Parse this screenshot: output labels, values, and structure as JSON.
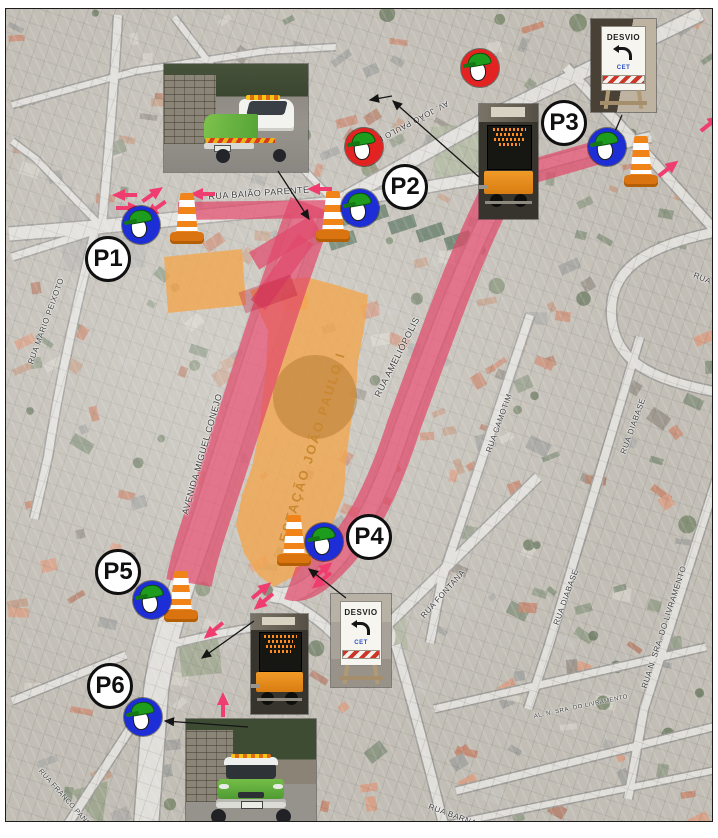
{
  "document": {
    "kind": "traffic-operation-plan-map",
    "area_label": "ESTAÇÃO JOÃO PAULO I"
  },
  "colors": {
    "closed_road": "#e0496b",
    "closed_road_dark_patch": "#be1e3c",
    "work_zone_orange": "#f3a64f",
    "work_zone_circle": "#ab7128",
    "arrow_pink": "#ee3d6e",
    "agent_blue": "#1d2ed6",
    "agent_red": "#e32222",
    "helmet_green": "#1e9c1e",
    "helmet_green_dark": "#157815",
    "cone_orange": "#f08418",
    "cone_base": "#da7410",
    "station_label_color": "#c9882f",
    "leader_black": "#151515"
  },
  "station": {
    "label": "ESTAÇÃO JOÃO PAULO I",
    "x": 306,
    "y": 438,
    "rot": -73,
    "size": 13
  },
  "points": [
    {
      "id": "P1",
      "label": "P1",
      "x": 102,
      "y": 250
    },
    {
      "id": "P2",
      "label": "P2",
      "x": 399,
      "y": 178
    },
    {
      "id": "P3",
      "label": "P3",
      "x": 558,
      "y": 114
    },
    {
      "id": "P4",
      "label": "P4",
      "x": 363,
      "y": 528
    },
    {
      "id": "P5",
      "label": "P5",
      "x": 112,
      "y": 563
    },
    {
      "id": "P6",
      "label": "P6",
      "x": 104,
      "y": 677
    }
  ],
  "agents": [
    {
      "variant": "blue",
      "x": 135,
      "y": 216
    },
    {
      "variant": "blue",
      "x": 354,
      "y": 199
    },
    {
      "variant": "blue",
      "x": 601,
      "y": 138
    },
    {
      "variant": "blue",
      "x": 318,
      "y": 533
    },
    {
      "variant": "blue",
      "x": 146,
      "y": 591
    },
    {
      "variant": "blue",
      "x": 137,
      "y": 708
    },
    {
      "variant": "red",
      "x": 358,
      "y": 138
    },
    {
      "variant": "red",
      "x": 474,
      "y": 59
    }
  ],
  "cones": [
    {
      "x": 181,
      "y": 209
    },
    {
      "x": 327,
      "y": 207
    },
    {
      "x": 635,
      "y": 152
    },
    {
      "x": 288,
      "y": 531
    },
    {
      "x": 175,
      "y": 587
    }
  ],
  "street_labels": [
    {
      "text": "RUA BAIÃO PARENTE",
      "x": 253,
      "y": 184,
      "rot": -4,
      "size": 9
    },
    {
      "text": "AV. JOÃO PAULO I",
      "x": 408,
      "y": 112,
      "rot": 152,
      "size": 8
    },
    {
      "text": "AVENIDA MIGUEL CONEJO",
      "x": 196,
      "y": 445,
      "rot": -74,
      "size": 9
    },
    {
      "text": "RUA AMELIÓPOLIS",
      "x": 391,
      "y": 348,
      "rot": -63,
      "size": 9
    },
    {
      "text": "RUA MARIO PEIXOTO",
      "x": 40,
      "y": 312,
      "rot": -70,
      "size": 8
    },
    {
      "text": "RUA FONTANA",
      "x": 437,
      "y": 585,
      "rot": -48,
      "size": 8
    },
    {
      "text": "RUA CAMOTIM",
      "x": 493,
      "y": 414,
      "rot": -70,
      "size": 8
    },
    {
      "text": "RUA DIABASE",
      "x": 627,
      "y": 417,
      "rot": -70,
      "size": 8
    },
    {
      "text": "RUA DIABASE",
      "x": 560,
      "y": 588,
      "rot": -70,
      "size": 8
    },
    {
      "text": "RUA N. SRA. DO LIVRAMENTO",
      "x": 658,
      "y": 618,
      "rot": -72,
      "size": 8
    },
    {
      "text": "RUA CA",
      "x": 703,
      "y": 272,
      "rot": 22,
      "size": 8
    },
    {
      "text": "RUA BARNABÉ",
      "x": 452,
      "y": 808,
      "rot": 20,
      "size": 8
    },
    {
      "text": "AL. N. SRA. DO LIVRAMENTO",
      "x": 575,
      "y": 698,
      "rot": -12,
      "size": 6
    },
    {
      "text": "RUA FRANCO PANCHA",
      "x": 62,
      "y": 793,
      "rot": 48,
      "size": 7
    }
  ],
  "signs": {
    "desvio": {
      "title": "DESVIO",
      "agency": "CET"
    }
  },
  "photos": [
    {
      "name": "support-pickup-photo-top",
      "type": "truck-side",
      "x": 158,
      "y": 55,
      "w": 144,
      "h": 108
    },
    {
      "name": "message-trailer-photo-top",
      "type": "trailer",
      "x": 473,
      "y": 95,
      "w": 59,
      "h": 115
    },
    {
      "name": "desvio-sign-photo-top",
      "type": "desvio",
      "bg": "dark",
      "x": 585,
      "y": 10,
      "w": 65,
      "h": 93
    },
    {
      "name": "desvio-sign-photo-mid",
      "type": "desvio",
      "bg": "light",
      "x": 325,
      "y": 585,
      "w": 60,
      "h": 93
    },
    {
      "name": "message-trailer-photo-mid",
      "type": "trailer",
      "x": 245,
      "y": 605,
      "w": 57,
      "h": 100
    },
    {
      "name": "support-pickup-photo-bottom",
      "type": "truck-front",
      "x": 180,
      "y": 710,
      "w": 130,
      "h": 112
    }
  ],
  "arrows": [
    {
      "x": 118,
      "y": 186,
      "rot": 180
    },
    {
      "x": 123,
      "y": 199,
      "rot": 0
    },
    {
      "x": 147,
      "y": 185,
      "rot": -35
    },
    {
      "x": 149,
      "y": 200,
      "rot": 145
    },
    {
      "x": 196,
      "y": 185,
      "rot": 180
    },
    {
      "x": 313,
      "y": 180,
      "rot": 180
    },
    {
      "x": 705,
      "y": 114,
      "rot": -38
    },
    {
      "x": 663,
      "y": 159,
      "rot": -38
    },
    {
      "x": 317,
      "y": 561,
      "rot": -40
    },
    {
      "x": 315,
      "y": 572,
      "rot": 140
    },
    {
      "x": 256,
      "y": 581,
      "rot": -40
    },
    {
      "x": 257,
      "y": 593,
      "rot": 140
    },
    {
      "x": 207,
      "y": 622,
      "rot": 140
    },
    {
      "x": 217,
      "y": 695,
      "rot": -90
    }
  ],
  "leaders": [
    {
      "x1": 272,
      "y1": 162,
      "x2": 303,
      "y2": 210
    },
    {
      "x1": 473,
      "y1": 168,
      "x2": 387,
      "y2": 92
    },
    {
      "x1": 616,
      "y1": 106,
      "x2": 605,
      "y2": 132
    },
    {
      "x1": 340,
      "y1": 589,
      "x2": 303,
      "y2": 560
    },
    {
      "x1": 248,
      "y1": 612,
      "x2": 196,
      "y2": 649
    },
    {
      "x1": 242,
      "y1": 718,
      "x2": 159,
      "y2": 712
    },
    {
      "x1": 386,
      "y1": 87,
      "x2": 364,
      "y2": 91
    }
  ]
}
